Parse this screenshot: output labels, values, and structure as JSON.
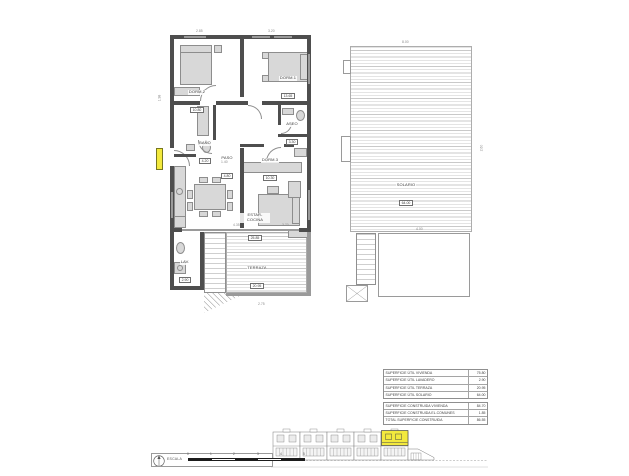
{
  "rooms": [
    {
      "name": "DORM.2",
      "area": "10.80"
    },
    {
      "name": "DORM.1",
      "area": "13.65"
    },
    {
      "name": "ASEO",
      "area": "3.30"
    },
    {
      "name": "BAÑO",
      "area": "4.20"
    },
    {
      "name": "PASO",
      "area": "4.80"
    },
    {
      "name": "DORM.3",
      "area": "10.30"
    },
    {
      "name": "ESTAR-COCINA",
      "area": "25.85"
    },
    {
      "name": "LAV.",
      "area": "2.90"
    },
    {
      "name": "TERRAZA",
      "area": "20.95"
    },
    {
      "name": "SOLARIO",
      "area": "64.00"
    }
  ],
  "dimensions": [
    "2.85",
    "3.20",
    "1.98",
    "1.40",
    "8.00",
    "2.60",
    "4.35",
    "3.70",
    "2.75",
    "4.00"
  ],
  "area_table": {
    "rows1": [
      {
        "label": "SUPERFICIE ÚTIL VIVIENDA",
        "value": "75.80"
      },
      {
        "label": "SUPERFICIE ÚTIL LAVADERO",
        "value": "2.90"
      },
      {
        "label": "SUPERFICIE ÚTIL TERRAZA",
        "value": "20.95"
      },
      {
        "label": "SUPERFICIE ÚTIL SOLARIO",
        "value": "64.00"
      }
    ],
    "rows2": [
      {
        "label": "SUPERFICIE CONSTRUIDA VIVIENDA",
        "value": "84.70"
      },
      {
        "label": "SUPERFICIE CONSTRUIDA EL.COMUNES",
        "value": "1.85"
      },
      {
        "label": "TOTAL SUPERFICIE CONSTRUIDA",
        "value": "86.55"
      }
    ]
  },
  "scale": {
    "label": "ESCALA",
    "ticks": [
      "0",
      "1",
      "2",
      "3",
      "4",
      "5"
    ]
  },
  "colors": {
    "wall": "#4e4e4e",
    "highlight": "#f3e93d"
  }
}
